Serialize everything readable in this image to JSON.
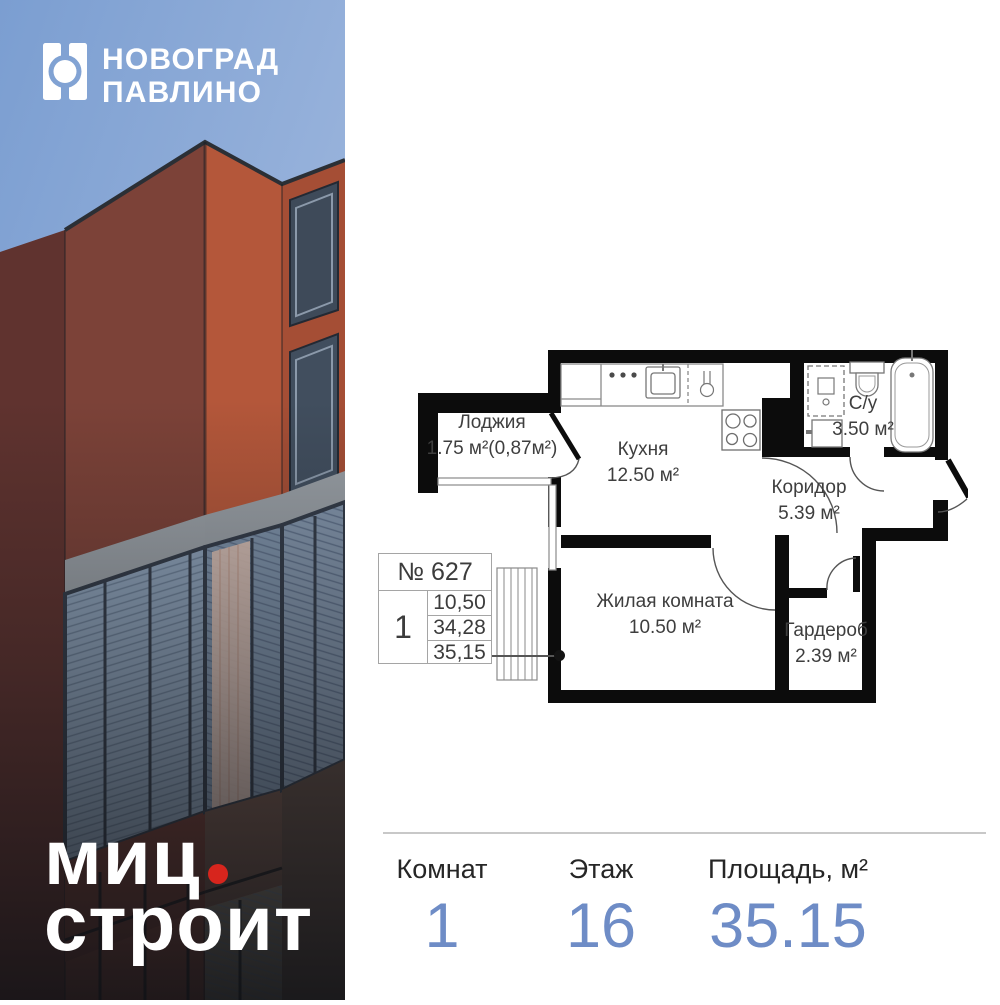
{
  "brand": {
    "project_line1": "НОВОГРАД",
    "project_line2": "ПАВЛИНО",
    "developer_line1": "миц",
    "developer_line2": "строит"
  },
  "plan": {
    "unit_label": "№ 627",
    "rooms_count": "1",
    "area_rows": [
      "10,50",
      "34,28",
      "35,15"
    ],
    "rooms": [
      {
        "name": "Лоджия",
        "area": "1.75 м²(0,87м²)"
      },
      {
        "name": "Кухня",
        "area": "12.50 м²"
      },
      {
        "name": "С/у",
        "area": "3.50 м²"
      },
      {
        "name": "Коридор",
        "area": "5.39 м²"
      },
      {
        "name": "Жилая комната",
        "area": "10.50 м²"
      },
      {
        "name": "Гардероб",
        "area": "2.39 м²"
      }
    ]
  },
  "stats": {
    "items": [
      {
        "label": "Комнат",
        "value": "1"
      },
      {
        "label": "Этаж",
        "value": "16"
      },
      {
        "label": "Площадь, м²",
        "value": "35.15"
      }
    ]
  },
  "colors": {
    "value_blue": "#6e8cc6",
    "brand_red": "#d7251d",
    "plan_wall": "#0c0c0c",
    "sky_blue": "#7b9ed1"
  }
}
